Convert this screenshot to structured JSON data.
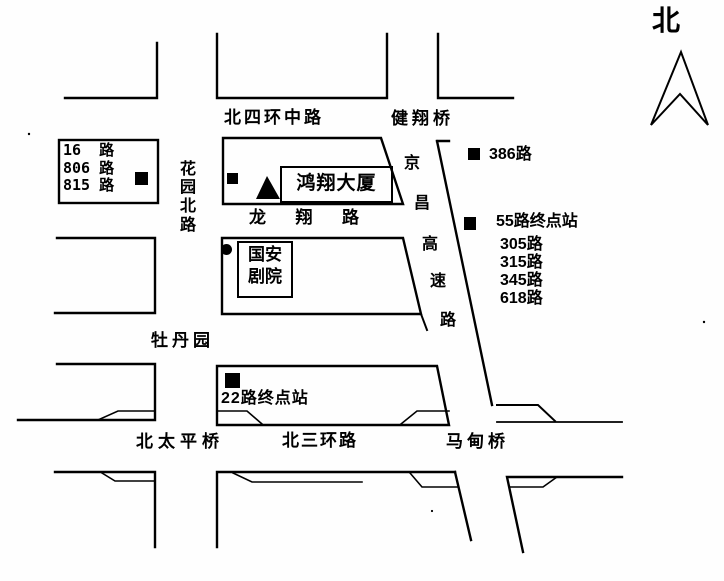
{
  "colors": {
    "ink": "#000000",
    "paper": "#fefefe"
  },
  "compass": {
    "north_label": "北"
  },
  "roads": {
    "north_fourth_ring_middle": "北四环中路",
    "jianxiang_bridge": "健翔桥",
    "huayuan_north_chars": [
      "花",
      "园",
      "北",
      "路"
    ],
    "longxiang_chars": [
      "龙",
      "翔",
      "路"
    ],
    "jingchang_expressway_chars": [
      "京",
      "昌",
      "高",
      "速",
      "路"
    ],
    "mudanyuan": "牡丹园",
    "beitaiping_bridge": "北太平桥",
    "north_third_ring": "北三环路",
    "madian_bridge": "马甸桥"
  },
  "buildings": {
    "hongxiang_tower": "鸿翔大厦",
    "guoan_theater_line1": "国安",
    "guoan_theater_line2": "剧院"
  },
  "bus_stops": {
    "huayuan_stop_lines": [
      "16  路",
      "806 路",
      "815 路"
    ],
    "stop_386": "386路",
    "terminal_55": "55路终点站",
    "terminal_55_lines": [
      "305路",
      "315路",
      "345路",
      "618路"
    ],
    "terminal_22": "22路终点站"
  }
}
